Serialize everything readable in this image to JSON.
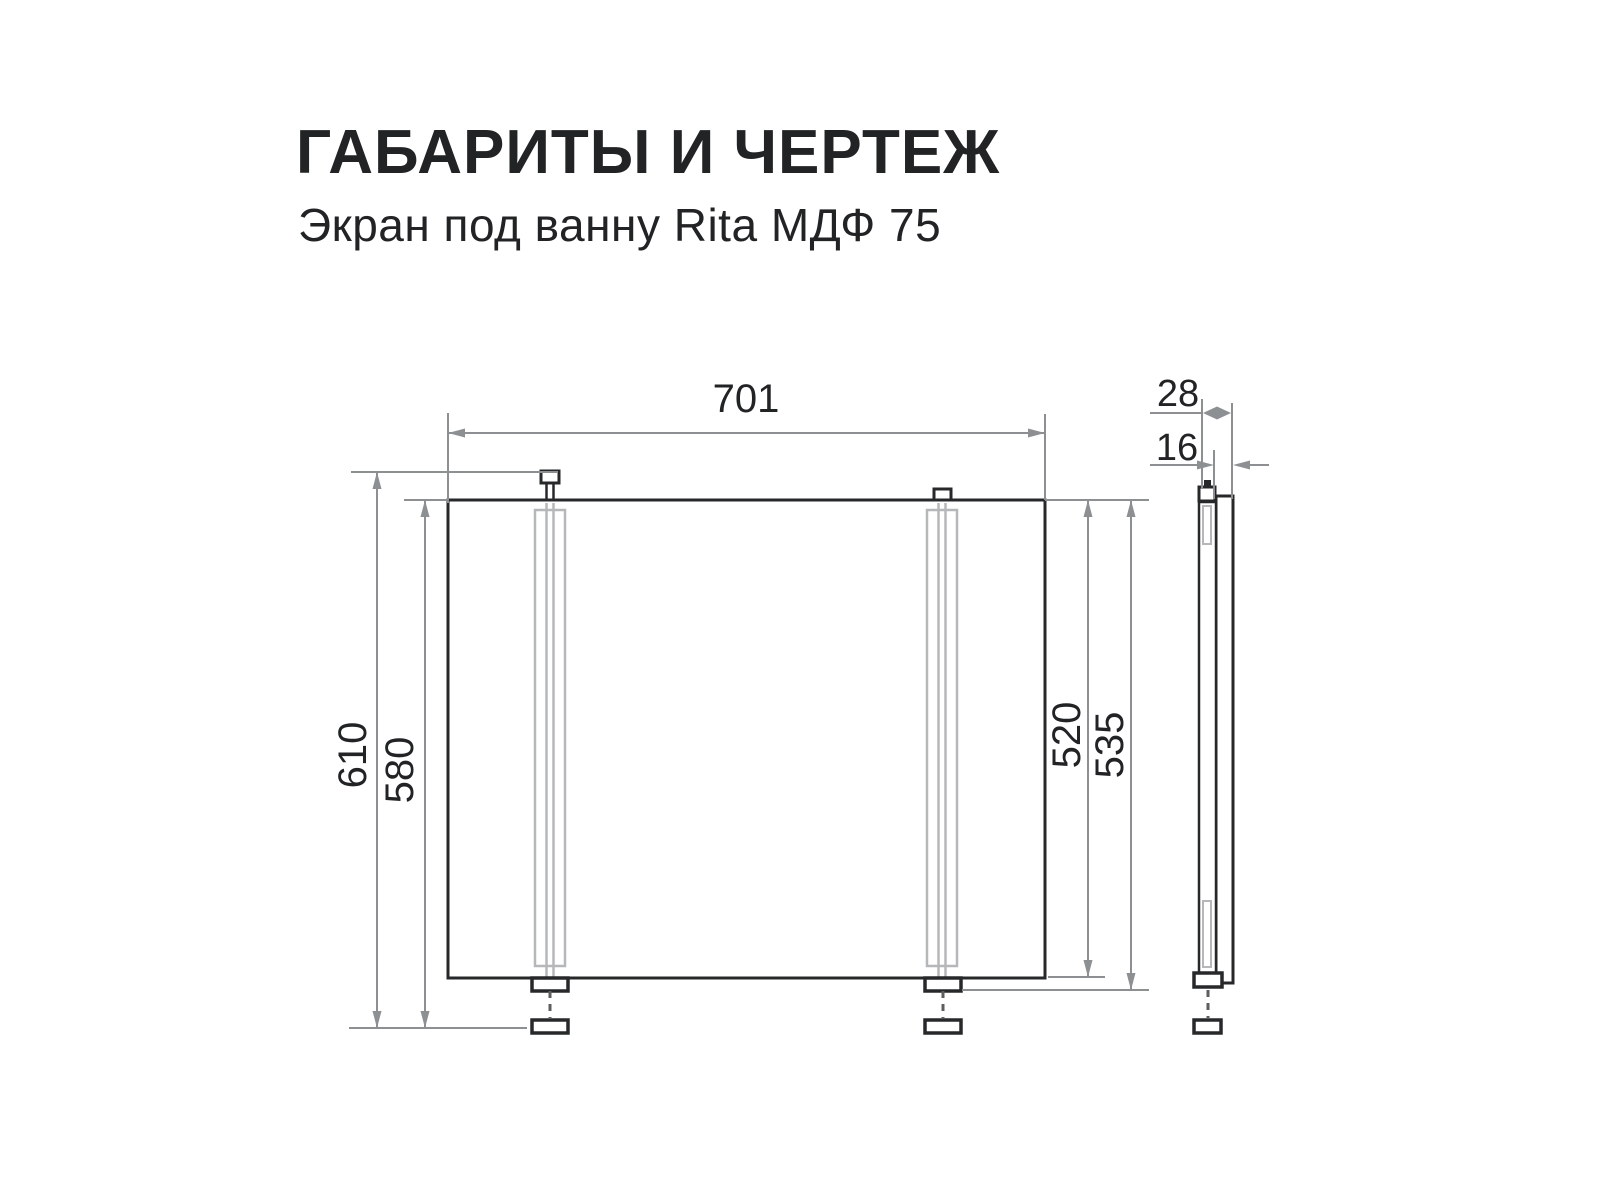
{
  "header": {
    "title": "ГАБАРИТЫ И ЧЕРТЕЖ",
    "subtitle": "Экран под ванну Rita МДФ 75"
  },
  "drawing": {
    "front_view": {
      "width": "701",
      "total_height": "610",
      "height_legs_extended": "580",
      "panel_height": "520",
      "height_with_foot": "535"
    },
    "side_view": {
      "total_depth": "28",
      "panel_thickness": "16"
    },
    "colors": {
      "outline": "#26282a",
      "dimension_gray": "#8d9092",
      "rail_gray": "#b5b7b9",
      "background": "#ffffff"
    }
  }
}
